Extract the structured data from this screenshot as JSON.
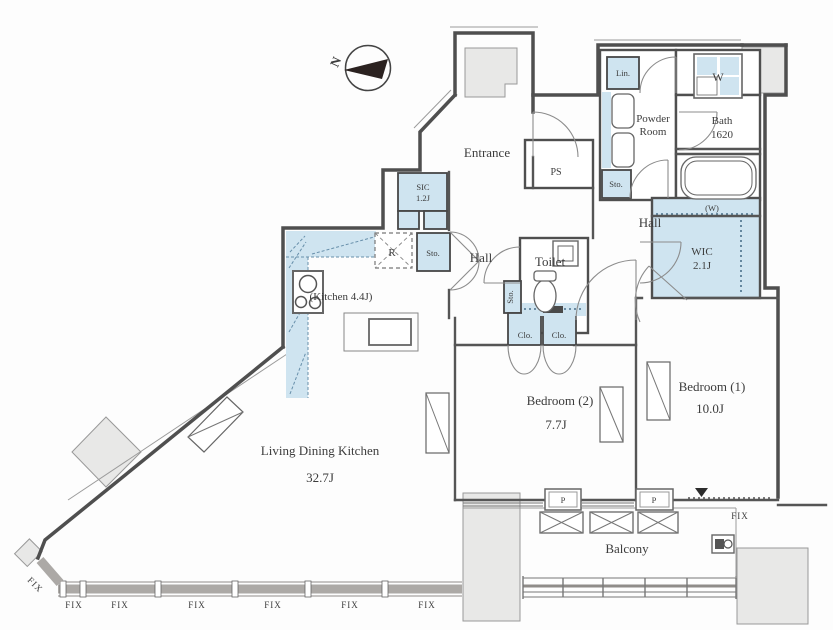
{
  "compass": {
    "label": "N"
  },
  "colors": {
    "storage_blue": "#cfe4f0",
    "column_gray": "#e8e8e7",
    "wall": "#4f4f4f",
    "window_band": "#aca9a6"
  },
  "labels": {
    "entrance": "Entrance",
    "ps": "PS",
    "lin": "Lin.",
    "washer": "W",
    "powder1": "Powder",
    "powder2": "Room",
    "bath1": "Bath",
    "bath2": "1620",
    "sto_top": "Sto.",
    "hall_right": "Hall",
    "w_hook": "(W)",
    "wic1": "WIC",
    "wic2": "2.1J",
    "sic1": "SIC",
    "sic2": "1.2J",
    "sto_hall": "Sto.",
    "hall_left": "Hall",
    "toilet": "Toilet",
    "sto_side": "Sto.",
    "fridge": "R",
    "kitchen": "(Kitchen 4.4J)",
    "clo1": "Clo.",
    "clo2": "Clo.",
    "bedroom2_name": "Bedroom (2)",
    "bedroom2_area": "7.7J",
    "bedroom1_name": "Bedroom (1)",
    "bedroom1_area": "10.0J",
    "ldk_name": "Living Dining Kitchen",
    "ldk_area": "32.7J",
    "balcony": "Balcony",
    "p1": "P",
    "p2": "P",
    "fix_right": "FIX",
    "fix_corner": "FIX",
    "fix_bottom": [
      "FIX",
      "FIX",
      "FIX",
      "FIX",
      "FIX",
      "FIX"
    ]
  }
}
